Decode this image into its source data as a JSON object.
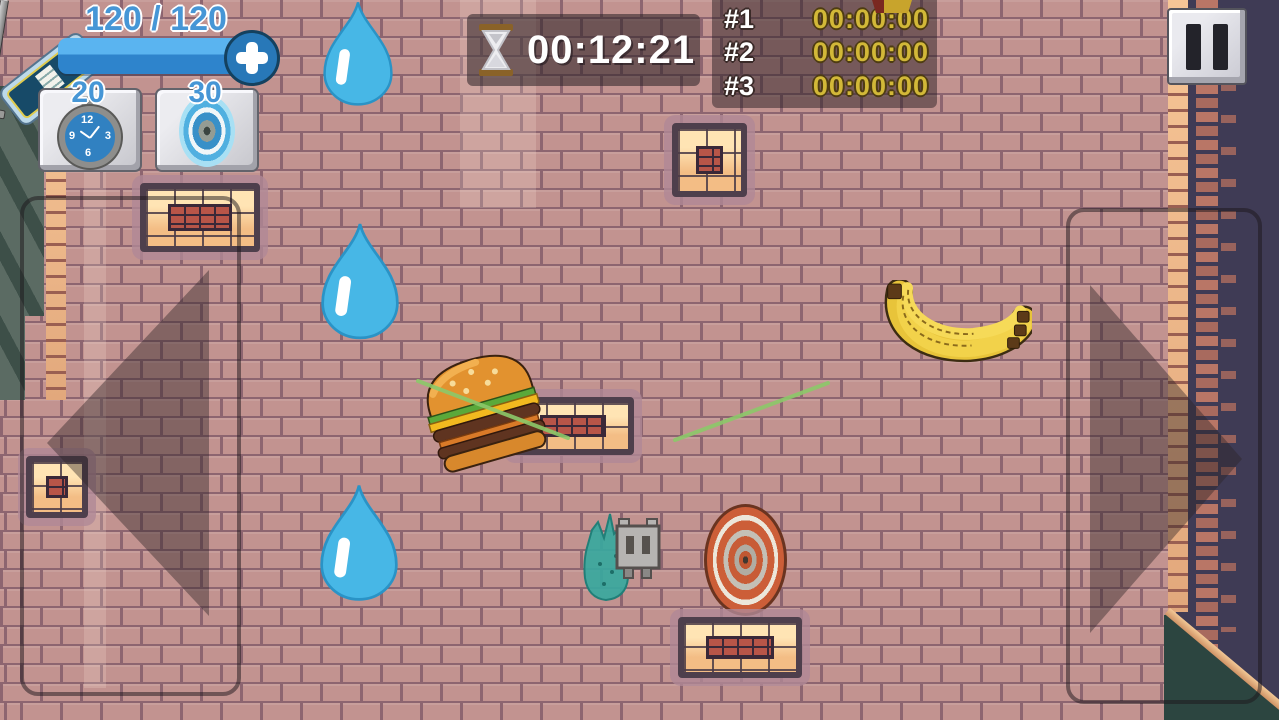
{
  "hud": {
    "health": {
      "display": "120 / 120"
    },
    "inventory": [
      {
        "icon": "stopwatch-icon",
        "count": "20",
        "clock_numerals": {
          "top": "12",
          "right": "3",
          "bottom": "6",
          "left": "9"
        }
      },
      {
        "icon": "portal-icon",
        "count": "30"
      }
    ],
    "timer": {
      "icon": "hourglass-icon",
      "value": "00:12:21"
    },
    "leaderboard": {
      "rows": [
        {
          "rank": "#1",
          "time": "00:00:00"
        },
        {
          "rank": "#2",
          "time": "00:00:00"
        },
        {
          "rank": "#3",
          "time": "00:00:00"
        }
      ]
    }
  },
  "icons": [
    "battery-pickup-icon",
    "plus-icon",
    "pause-icon",
    "hourglass-icon",
    "stopwatch-icon",
    "portal-icon",
    "left-arrow-icon",
    "right-arrow-icon"
  ],
  "game_objects": [
    "water-drop",
    "burger",
    "bananas",
    "target",
    "player-robot",
    "slime-creature",
    "sword",
    "laser-beam"
  ],
  "colors": {
    "brick_wall": "#c29390",
    "mortar": "#8d6570",
    "dark_side": "#3f3b55",
    "accent_blue": "#4696d6",
    "health_bar": "#2e84cc",
    "gold_time": "#d2b838",
    "laser_green": "#8cc96a",
    "water_drop": "#47b7e6",
    "panel": "rgba(42,32,36,0.55)",
    "platform_light": "#f6c795",
    "platform_frame": "#4e3f4c"
  }
}
